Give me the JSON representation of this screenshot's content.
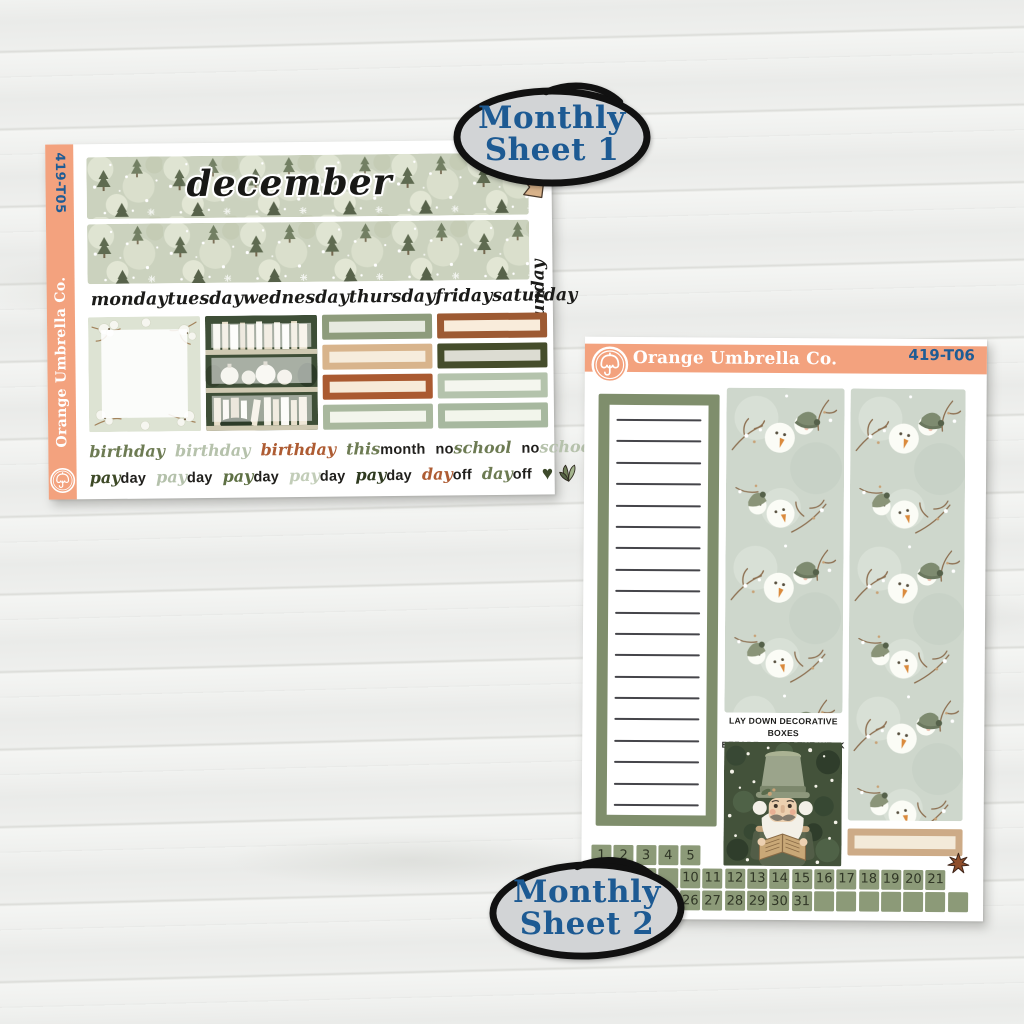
{
  "badges": {
    "badge1": {
      "line1": "Monthly",
      "line2": "Sheet 1"
    },
    "badge2": {
      "line1": "Monthly",
      "line2": "Sheet 2"
    }
  },
  "sheet1": {
    "code": "419-T05",
    "brand": "Orange Umbrella Co.",
    "month_title": "december",
    "weekday_labels": [
      "monday",
      "tuesday",
      "wednesday",
      "thursday",
      "friday",
      "saturday"
    ],
    "sunday_label": "sunday",
    "quarter_boxes": {
      "col1": [
        {
          "border": "#8e9c7c",
          "fill": "#e7eae0"
        },
        {
          "border": "#d8b48c",
          "fill": "#f6ecdc"
        },
        {
          "border": "#aa5a31",
          "fill": "#f7ead8"
        },
        {
          "border": "#a9b89e",
          "fill": "#f3f5ec"
        }
      ],
      "col2": [
        {
          "border": "#9d5a33",
          "fill": "#f9ecdb"
        },
        {
          "border": "#454d2b",
          "fill": "#dcdcd2"
        },
        {
          "border": "#b4c3ac",
          "fill": "#f4f6ee"
        },
        {
          "border": "#a7b89f",
          "fill": "#f2f5eb"
        }
      ]
    },
    "event_row1": [
      {
        "parts": [
          {
            "t": "birthday",
            "s": "script",
            "c": "#6d7b53"
          }
        ]
      },
      {
        "parts": [
          {
            "t": "birthday",
            "s": "script",
            "c": "#b6c2ac"
          }
        ]
      },
      {
        "parts": [
          {
            "t": "birthday",
            "s": "script",
            "c": "#ae5c33"
          }
        ]
      },
      {
        "parts": [
          {
            "t": "this",
            "s": "script",
            "c": "#6d7b53"
          },
          {
            "t": "month",
            "s": "print",
            "c": "#201f1c"
          }
        ]
      },
      {
        "parts": [
          {
            "t": "no",
            "s": "print",
            "c": "#201f1c"
          },
          {
            "t": "school",
            "s": "script",
            "c": "#6d7b53"
          }
        ]
      },
      {
        "parts": [
          {
            "t": "no",
            "s": "print",
            "c": "#201f1c"
          },
          {
            "t": "school",
            "s": "script",
            "c": "#b6c2ac"
          }
        ]
      }
    ],
    "event_row2": [
      {
        "parts": [
          {
            "t": "pay",
            "s": "script",
            "c": "#3e4a27"
          },
          {
            "t": "day",
            "s": "print",
            "c": "#201f1c"
          }
        ]
      },
      {
        "parts": [
          {
            "t": "pay",
            "s": "script",
            "c": "#b4c1ab"
          },
          {
            "t": "day",
            "s": "print",
            "c": "#201f1c"
          }
        ]
      },
      {
        "parts": [
          {
            "t": "pay",
            "s": "script",
            "c": "#5f7145"
          },
          {
            "t": "day",
            "s": "print",
            "c": "#201f1c"
          }
        ]
      },
      {
        "parts": [
          {
            "t": "pay",
            "s": "script",
            "c": "#c2cdb8"
          },
          {
            "t": "day",
            "s": "print",
            "c": "#201f1c"
          }
        ]
      },
      {
        "parts": [
          {
            "t": "pay",
            "s": "script",
            "c": "#2f3a20"
          },
          {
            "t": "day",
            "s": "print",
            "c": "#201f1c"
          }
        ]
      },
      {
        "parts": [
          {
            "t": "day",
            "s": "script",
            "c": "#ae5c33"
          },
          {
            "t": "off",
            "s": "print",
            "c": "#201f1c"
          }
        ]
      },
      {
        "parts": [
          {
            "t": "day",
            "s": "script",
            "c": "#6d7b53"
          },
          {
            "t": "off",
            "s": "print",
            "c": "#201f1c"
          }
        ]
      }
    ]
  },
  "sheet2": {
    "brand": "Orange Umbrella Co.",
    "code": "419-T06",
    "instruction_line1": "LAY DOWN DECORATIVE BOXES",
    "instruction_line2": "BEFORE DAY OF THE WEEK SCRIPTS",
    "notes_lines": 19,
    "tan_box": {
      "border": "#cdab87",
      "fill": "#f3ead9"
    },
    "date_rows": {
      "row1": [
        "1",
        "2",
        "3",
        "4",
        "5"
      ],
      "row2": [
        "",
        "",
        "",
        "",
        "10",
        "11",
        "12",
        "13",
        "14",
        "15",
        "16",
        "17",
        "18",
        "19",
        "20",
        "21"
      ],
      "row3": [
        "",
        "",
        "",
        "",
        "26",
        "27",
        "28",
        "29",
        "30",
        "31",
        "",
        "",
        "",
        "",
        "",
        "",
        ""
      ]
    }
  },
  "icons": {
    "heart": "♥"
  },
  "colors": {
    "peach": "#f3a27e",
    "badge_blue": "#1d5a93",
    "badge_fill": "#d2d4d6",
    "date_square_green": "#8c9a78",
    "notes_border_green": "#7f8e6c",
    "rust": "#ae5c33",
    "olive": "#6d7b53",
    "pale_sage": "#b6c2ac"
  }
}
